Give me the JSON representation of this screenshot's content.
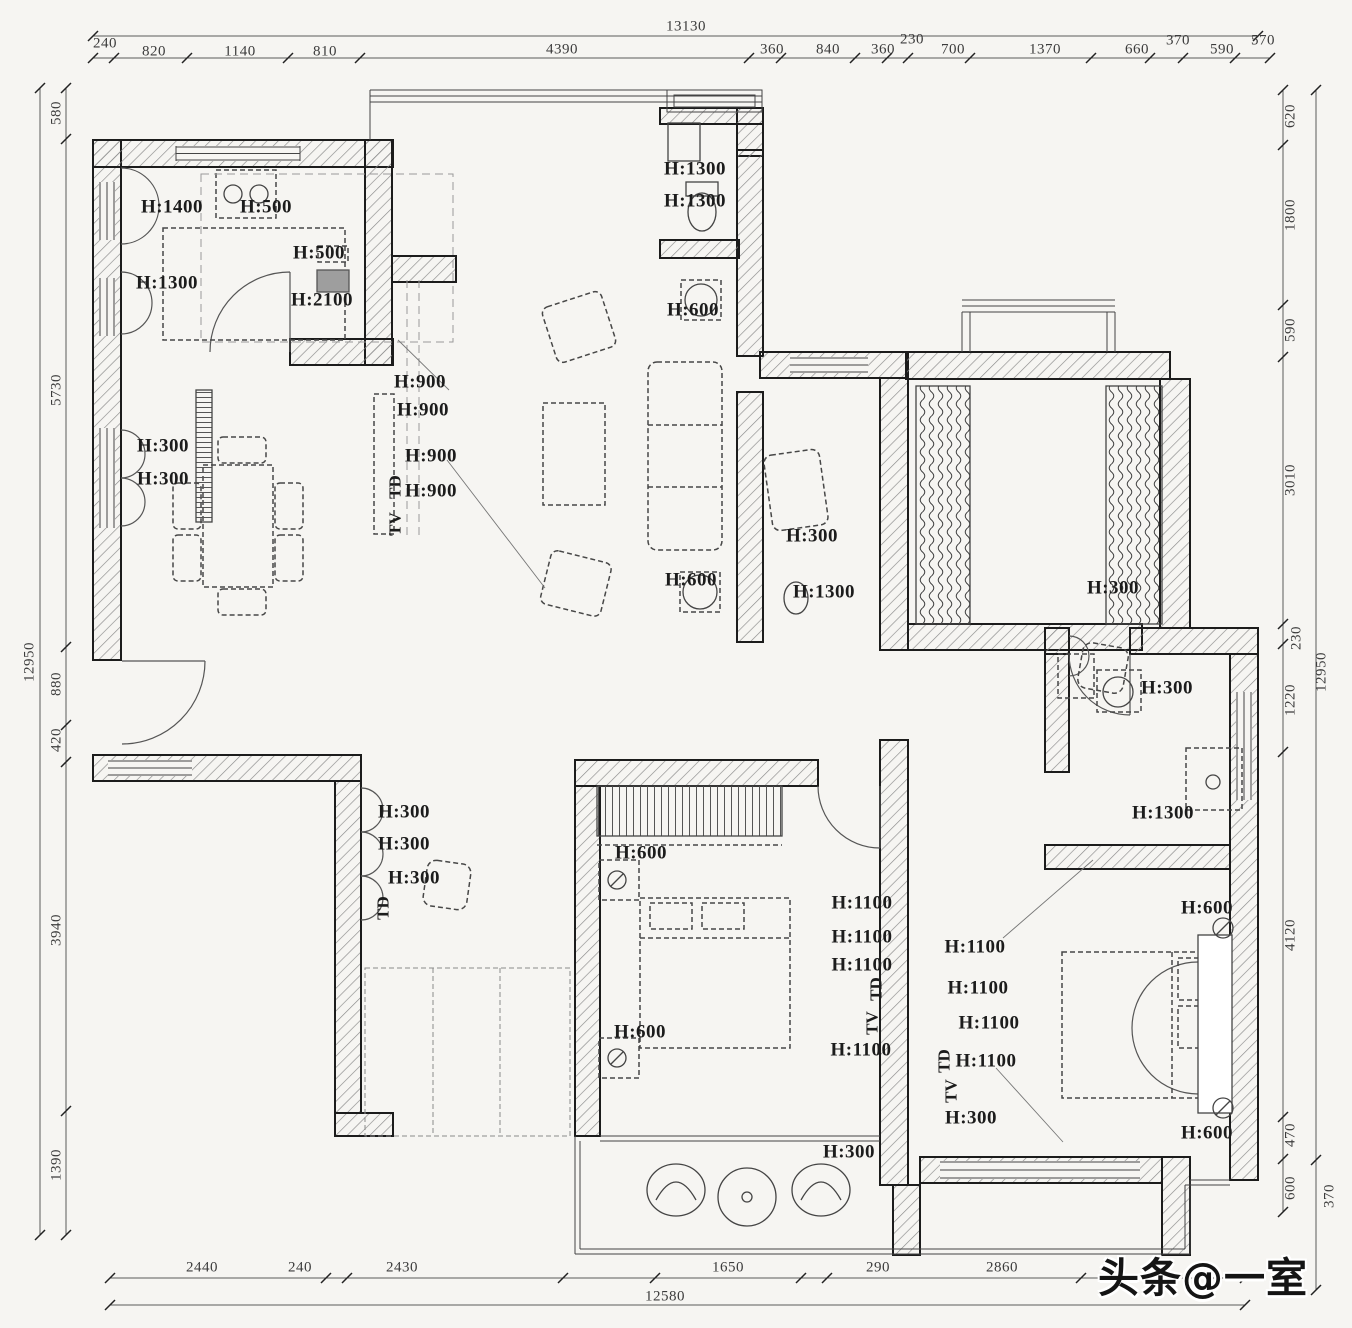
{
  "canvas": {
    "background": "#f6f5f2",
    "ink": "#2b2b2b",
    "hatch": "#8a8a8a",
    "appliance_gray": "#9e9e9e"
  },
  "watermark": {
    "text": "头条@一室"
  },
  "labels": [
    {
      "text": "13130",
      "x": 686,
      "y": 27,
      "rot": 0,
      "kind": "dim-total"
    },
    {
      "text": "240",
      "x": 105,
      "y": 44,
      "rot": 0,
      "kind": "dim"
    },
    {
      "text": "820",
      "x": 154,
      "y": 52,
      "rot": 0,
      "kind": "dim"
    },
    {
      "text": "1140",
      "x": 240,
      "y": 52,
      "rot": 0,
      "kind": "dim"
    },
    {
      "text": "810",
      "x": 325,
      "y": 52,
      "rot": 0,
      "kind": "dim"
    },
    {
      "text": "4390",
      "x": 562,
      "y": 50,
      "rot": 0,
      "kind": "dim"
    },
    {
      "text": "360",
      "x": 772,
      "y": 50,
      "rot": 0,
      "kind": "dim"
    },
    {
      "text": "840",
      "x": 828,
      "y": 50,
      "rot": 0,
      "kind": "dim"
    },
    {
      "text": "360",
      "x": 883,
      "y": 50,
      "rot": 0,
      "kind": "dim"
    },
    {
      "text": "230",
      "x": 912,
      "y": 40,
      "rot": 0,
      "kind": "dim"
    },
    {
      "text": "700",
      "x": 953,
      "y": 50,
      "rot": 0,
      "kind": "dim"
    },
    {
      "text": "1370",
      "x": 1045,
      "y": 50,
      "rot": 0,
      "kind": "dim"
    },
    {
      "text": "660",
      "x": 1137,
      "y": 50,
      "rot": 0,
      "kind": "dim"
    },
    {
      "text": "370",
      "x": 1178,
      "y": 41,
      "rot": 0,
      "kind": "dim"
    },
    {
      "text": "590",
      "x": 1222,
      "y": 50,
      "rot": 0,
      "kind": "dim"
    },
    {
      "text": "570",
      "x": 1263,
      "y": 41,
      "rot": 0,
      "kind": "dim"
    },
    {
      "text": "580",
      "x": 57,
      "y": 113,
      "rot": -90,
      "kind": "dim"
    },
    {
      "text": "5730",
      "x": 57,
      "y": 390,
      "rot": -90,
      "kind": "dim"
    },
    {
      "text": "880",
      "x": 57,
      "y": 684,
      "rot": -90,
      "kind": "dim"
    },
    {
      "text": "420",
      "x": 57,
      "y": 740,
      "rot": -90,
      "kind": "dim"
    },
    {
      "text": "3940",
      "x": 57,
      "y": 930,
      "rot": -90,
      "kind": "dim"
    },
    {
      "text": "1390",
      "x": 57,
      "y": 1165,
      "rot": -90,
      "kind": "dim"
    },
    {
      "text": "12950",
      "x": 30,
      "y": 662,
      "rot": -90,
      "kind": "dim-total"
    },
    {
      "text": "620",
      "x": 1291,
      "y": 116,
      "rot": -90,
      "kind": "dim"
    },
    {
      "text": "1800",
      "x": 1291,
      "y": 215,
      "rot": -90,
      "kind": "dim"
    },
    {
      "text": "590",
      "x": 1291,
      "y": 330,
      "rot": -90,
      "kind": "dim"
    },
    {
      "text": "3010",
      "x": 1291,
      "y": 480,
      "rot": -90,
      "kind": "dim"
    },
    {
      "text": "230",
      "x": 1297,
      "y": 638,
      "rot": -90,
      "kind": "dim"
    },
    {
      "text": "1220",
      "x": 1291,
      "y": 700,
      "rot": -90,
      "kind": "dim"
    },
    {
      "text": "4120",
      "x": 1291,
      "y": 935,
      "rot": -90,
      "kind": "dim"
    },
    {
      "text": "470",
      "x": 1291,
      "y": 1135,
      "rot": -90,
      "kind": "dim"
    },
    {
      "text": "600",
      "x": 1291,
      "y": 1188,
      "rot": -90,
      "kind": "dim"
    },
    {
      "text": "12950",
      "x": 1322,
      "y": 672,
      "rot": -90,
      "kind": "dim-total"
    },
    {
      "text": "370",
      "x": 1330,
      "y": 1196,
      "rot": -90,
      "kind": "dim"
    },
    {
      "text": "2440",
      "x": 202,
      "y": 1268,
      "rot": 0,
      "kind": "dim"
    },
    {
      "text": "240",
      "x": 300,
      "y": 1268,
      "rot": 0,
      "kind": "dim"
    },
    {
      "text": "2430",
      "x": 402,
      "y": 1268,
      "rot": 0,
      "kind": "dim"
    },
    {
      "text": "1650",
      "x": 728,
      "y": 1268,
      "rot": 0,
      "kind": "dim"
    },
    {
      "text": "290",
      "x": 878,
      "y": 1268,
      "rot": 0,
      "kind": "dim"
    },
    {
      "text": "2860",
      "x": 1002,
      "y": 1268,
      "rot": 0,
      "kind": "dim"
    },
    {
      "text": "12580",
      "x": 665,
      "y": 1297,
      "rot": 0,
      "kind": "dim-total"
    },
    {
      "text": "H:1400",
      "x": 172,
      "y": 207,
      "rot": 0,
      "kind": "height"
    },
    {
      "text": "H:500",
      "x": 266,
      "y": 207,
      "rot": 0,
      "kind": "height"
    },
    {
      "text": "H:500",
      "x": 319,
      "y": 253,
      "rot": 0,
      "kind": "height"
    },
    {
      "text": "H:1300",
      "x": 167,
      "y": 283,
      "rot": 0,
      "kind": "height"
    },
    {
      "text": "H:2100",
      "x": 322,
      "y": 300,
      "rot": 0,
      "kind": "height"
    },
    {
      "text": "H:900",
      "x": 420,
      "y": 382,
      "rot": 0,
      "kind": "height"
    },
    {
      "text": "H:900",
      "x": 423,
      "y": 410,
      "rot": 0,
      "kind": "height"
    },
    {
      "text": "H:900",
      "x": 431,
      "y": 456,
      "rot": 0,
      "kind": "height"
    },
    {
      "text": "H:900",
      "x": 431,
      "y": 491,
      "rot": 0,
      "kind": "height"
    },
    {
      "text": "TD",
      "x": 395,
      "y": 487,
      "rot": -90,
      "kind": "code"
    },
    {
      "text": "TV",
      "x": 395,
      "y": 524,
      "rot": -90,
      "kind": "code"
    },
    {
      "text": "H:300",
      "x": 163,
      "y": 446,
      "rot": 0,
      "kind": "height"
    },
    {
      "text": "H:300",
      "x": 163,
      "y": 479,
      "rot": 0,
      "kind": "height"
    },
    {
      "text": "H:1300",
      "x": 695,
      "y": 169,
      "rot": 0,
      "kind": "height"
    },
    {
      "text": "H:1300",
      "x": 695,
      "y": 201,
      "rot": 0,
      "kind": "height"
    },
    {
      "text": "H:600",
      "x": 693,
      "y": 310,
      "rot": 0,
      "kind": "height"
    },
    {
      "text": "H:600",
      "x": 691,
      "y": 580,
      "rot": 0,
      "kind": "height"
    },
    {
      "text": "H:300",
      "x": 812,
      "y": 536,
      "rot": 0,
      "kind": "height"
    },
    {
      "text": "H:1300",
      "x": 824,
      "y": 592,
      "rot": 0,
      "kind": "height"
    },
    {
      "text": "H:300",
      "x": 1113,
      "y": 588,
      "rot": 0,
      "kind": "height"
    },
    {
      "text": "H:300",
      "x": 1167,
      "y": 688,
      "rot": 0,
      "kind": "height"
    },
    {
      "text": "H:1300",
      "x": 1163,
      "y": 813,
      "rot": 0,
      "kind": "height"
    },
    {
      "text": "H:300",
      "x": 404,
      "y": 812,
      "rot": 0,
      "kind": "height"
    },
    {
      "text": "H:300",
      "x": 404,
      "y": 844,
      "rot": 0,
      "kind": "height"
    },
    {
      "text": "H:300",
      "x": 414,
      "y": 878,
      "rot": 0,
      "kind": "height"
    },
    {
      "text": "TD",
      "x": 383,
      "y": 908,
      "rot": -90,
      "kind": "code"
    },
    {
      "text": "H:600",
      "x": 641,
      "y": 853,
      "rot": 0,
      "kind": "height"
    },
    {
      "text": "H:600",
      "x": 640,
      "y": 1032,
      "rot": 0,
      "kind": "height"
    },
    {
      "text": "H:1100",
      "x": 862,
      "y": 903,
      "rot": 0,
      "kind": "height"
    },
    {
      "text": "H:1100",
      "x": 862,
      "y": 937,
      "rot": 0,
      "kind": "height"
    },
    {
      "text": "H:1100",
      "x": 862,
      "y": 965,
      "rot": 0,
      "kind": "height"
    },
    {
      "text": "TD",
      "x": 876,
      "y": 989,
      "rot": -90,
      "kind": "code"
    },
    {
      "text": "TV",
      "x": 872,
      "y": 1023,
      "rot": -90,
      "kind": "code"
    },
    {
      "text": "H:1100",
      "x": 861,
      "y": 1050,
      "rot": 0,
      "kind": "height"
    },
    {
      "text": "H:1100",
      "x": 975,
      "y": 947,
      "rot": 0,
      "kind": "height"
    },
    {
      "text": "H:1100",
      "x": 978,
      "y": 988,
      "rot": 0,
      "kind": "height"
    },
    {
      "text": "H:1100",
      "x": 989,
      "y": 1023,
      "rot": 0,
      "kind": "height"
    },
    {
      "text": "TD",
      "x": 944,
      "y": 1061,
      "rot": -90,
      "kind": "code"
    },
    {
      "text": "H:1100",
      "x": 986,
      "y": 1061,
      "rot": 0,
      "kind": "height"
    },
    {
      "text": "TV",
      "x": 951,
      "y": 1091,
      "rot": -90,
      "kind": "code"
    },
    {
      "text": "H:300",
      "x": 971,
      "y": 1118,
      "rot": 0,
      "kind": "height"
    },
    {
      "text": "H:300",
      "x": 849,
      "y": 1152,
      "rot": 0,
      "kind": "height"
    },
    {
      "text": "H:600",
      "x": 1207,
      "y": 908,
      "rot": 0,
      "kind": "height"
    },
    {
      "text": "H:600",
      "x": 1207,
      "y": 1133,
      "rot": 0,
      "kind": "height"
    }
  ]
}
